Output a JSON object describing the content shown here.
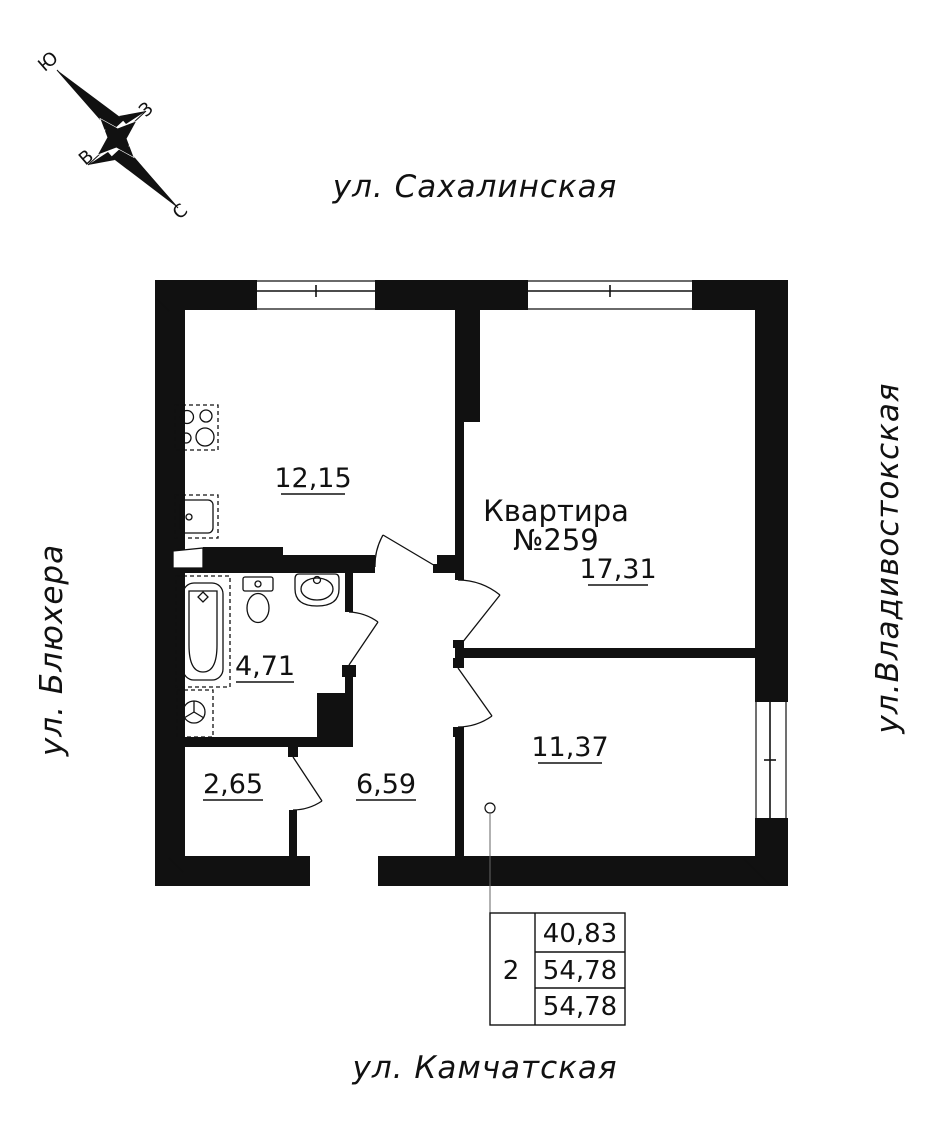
{
  "plan": {
    "streets": {
      "top": "ул. Сахалинская",
      "left": "ул. Блюхера",
      "right": "ул.Владивостокская",
      "bottom": "ул. Камчатская"
    },
    "compass": {
      "south": "Ю",
      "west": "З",
      "east": "В",
      "north": "С"
    },
    "apartment": {
      "title": "Квартира",
      "number": "№259"
    },
    "rooms": {
      "kitchen": "12,15",
      "living": "17,31",
      "bathroom": "4,71",
      "storage": "2,65",
      "hallway": "6,59",
      "bedroom": "11,37"
    },
    "summary_table": {
      "rooms_count": "2",
      "living_area": "40,83",
      "apartment_area": "54,78",
      "total_area": "54,78"
    },
    "colors": {
      "ink": "#111111",
      "paper": "#ffffff"
    }
  }
}
